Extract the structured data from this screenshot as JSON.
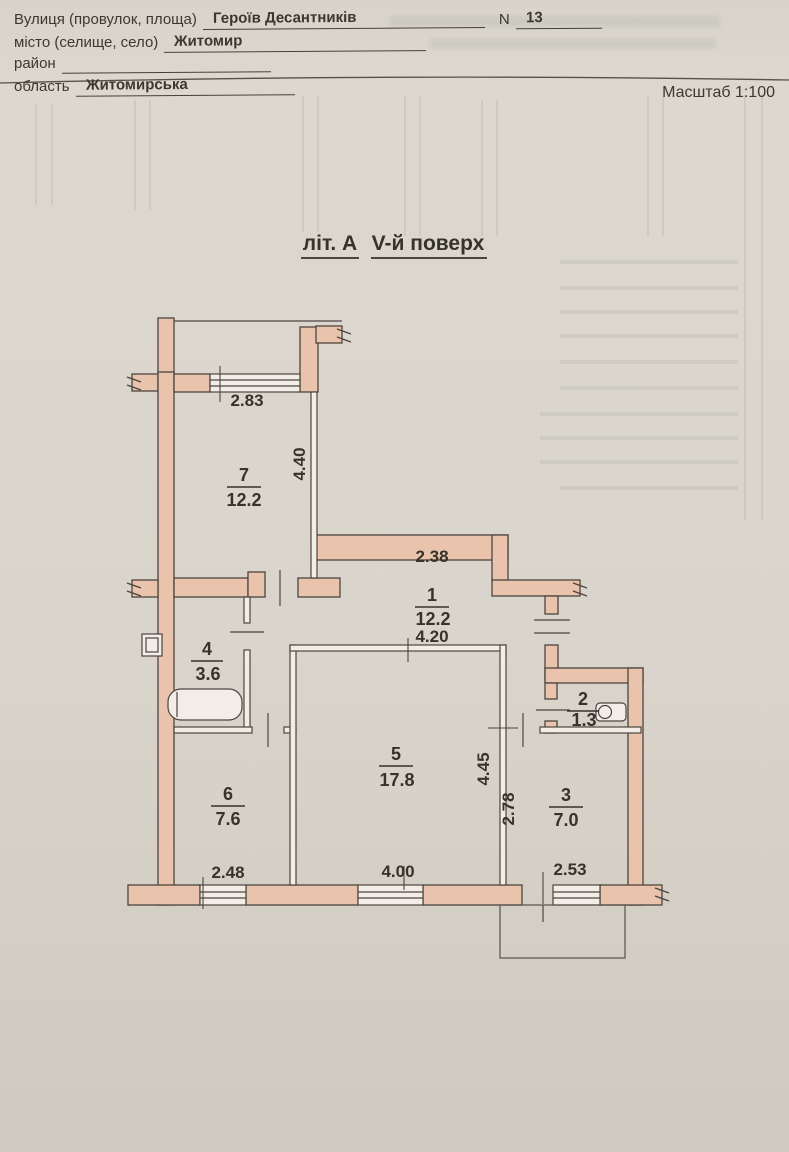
{
  "header": {
    "street_label": "Вулиця (провулок, площа)",
    "street_value": "Героїв Десантників",
    "number_label": "N",
    "number_value": "13",
    "city_label": "місто (селище, село)",
    "city_value": "Житомир",
    "district_label": "район",
    "district_value": "",
    "region_label": "область",
    "region_value": "Житомирська",
    "scale_label": "Масштаб 1:100"
  },
  "plan": {
    "letter": "літ. А",
    "floor": "V-й поверх",
    "rooms": [
      {
        "number": "7",
        "area": "12.2"
      },
      {
        "number": "1",
        "area": "12.2"
      },
      {
        "number": "4",
        "area": "3.6"
      },
      {
        "number": "5",
        "area": "17.8"
      },
      {
        "number": "6",
        "area": "7.6"
      },
      {
        "number": "2",
        "area": "1.3"
      },
      {
        "number": "3",
        "area": "7.0"
      }
    ],
    "dimensions": {
      "d283": "2.83",
      "d440": "4.40",
      "d238": "2.38",
      "d420": "4.20",
      "d445": "4.45",
      "d278": "2.78",
      "d248": "2.48",
      "d400": "4.00",
      "d253": "2.53"
    },
    "colors": {
      "wall_fill": "#e9c3ac",
      "line": "#4c453f",
      "paper": "#f2eee7"
    }
  }
}
